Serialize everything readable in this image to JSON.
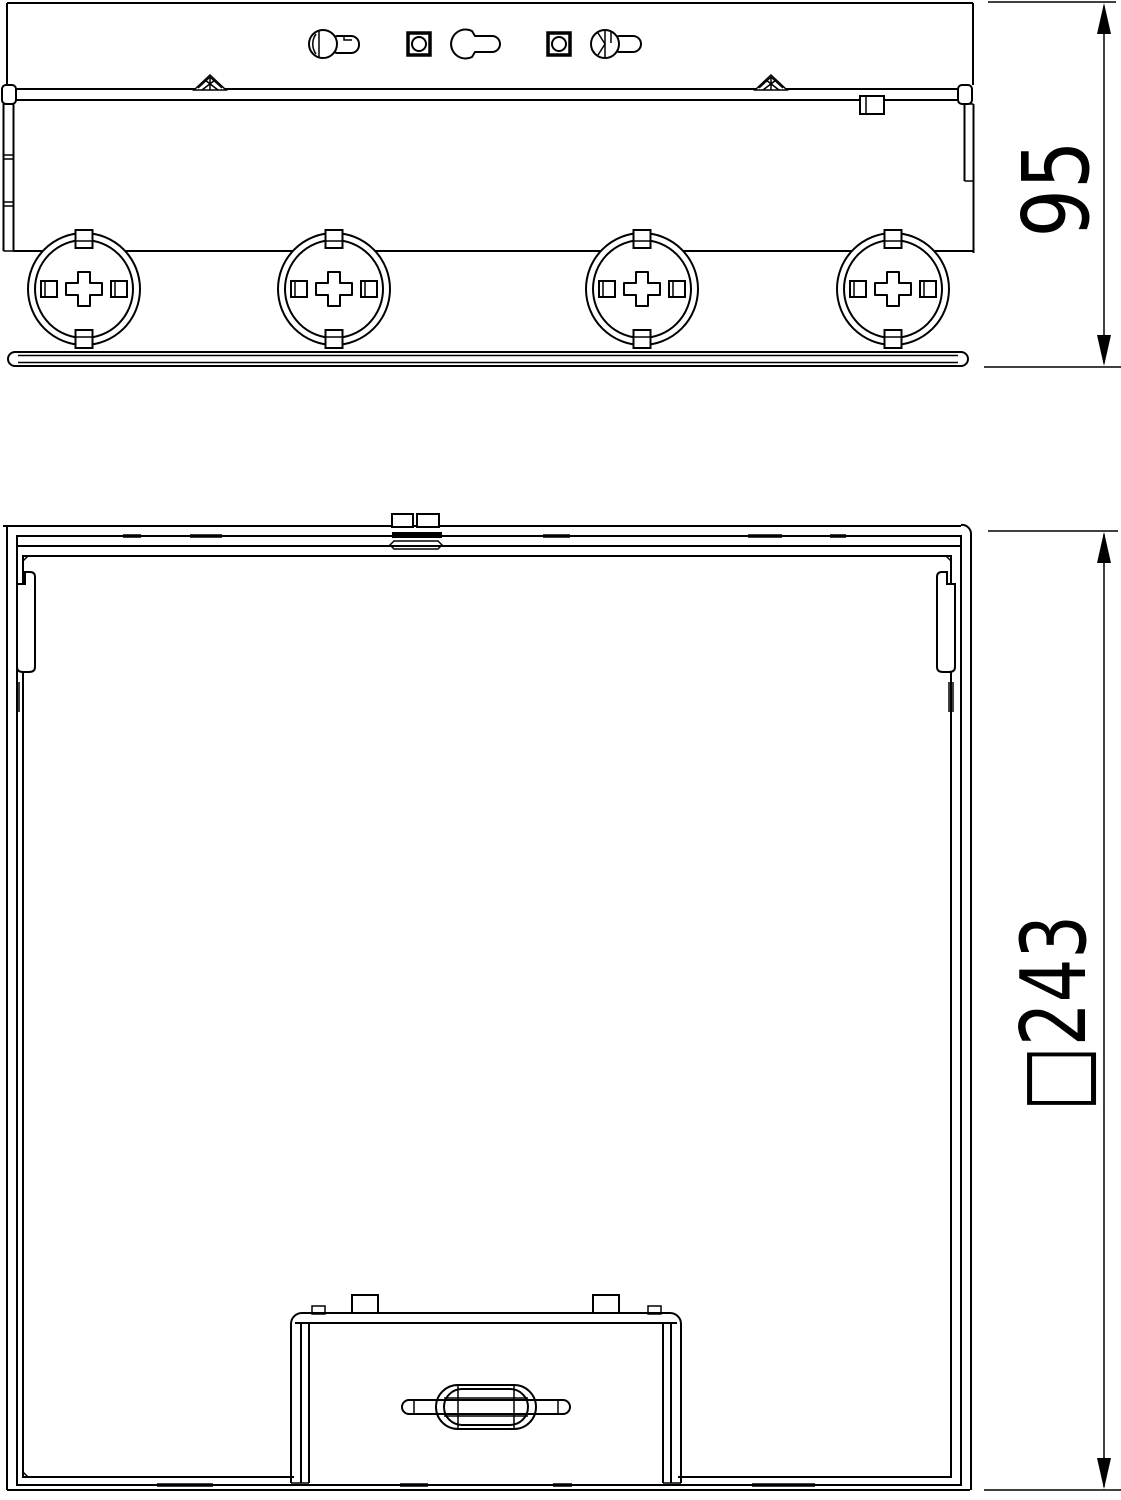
{
  "drawing": {
    "background": "#ffffff",
    "line_color": "#000000",
    "side_view": {
      "label": "side elevation of floor box",
      "knockout_count": 4,
      "height_dimension": "95"
    },
    "plan_view": {
      "label": "plan view of floor box frame with cover plate",
      "square_dimension": "□243"
    }
  }
}
